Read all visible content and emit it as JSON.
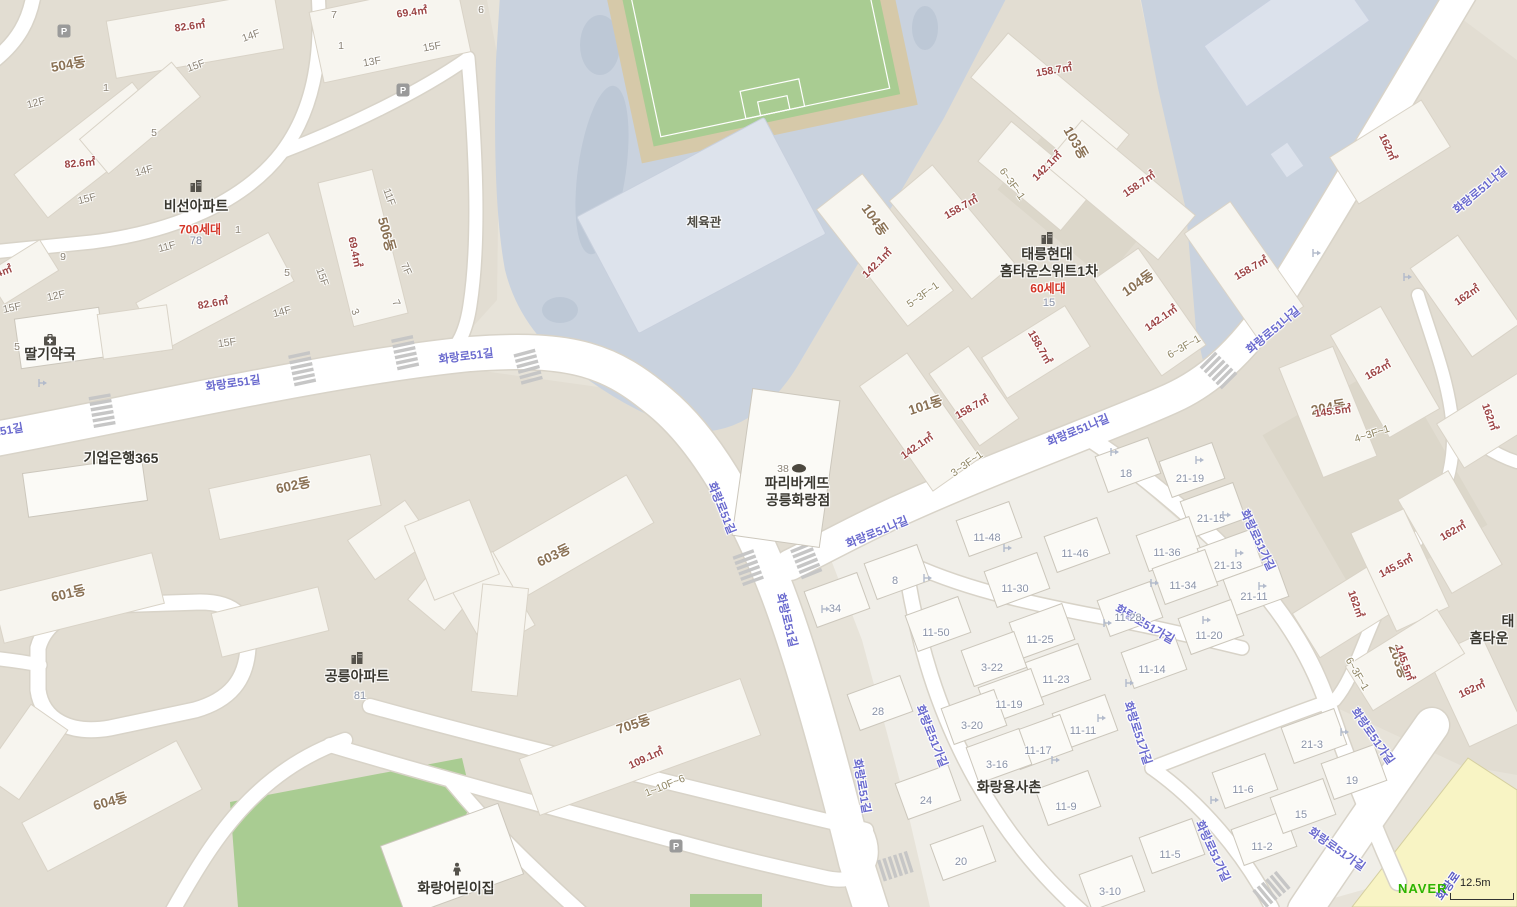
{
  "map": {
    "attribution": "NAVER",
    "scale": "12.5m",
    "colors": {
      "road_label": "#6a6ace",
      "dong_label": "#8a7154",
      "area_label": "#9c4444",
      "lot_label": "#8a93a8",
      "households_label": "#d43527",
      "poi_label": "#39372f",
      "school_ground": "#c9d2de",
      "field_green": "#a9cc92",
      "major_road_yellow": "#f8f4c4",
      "brand_green": "#2db400"
    },
    "labels": [
      {
        "t": "화랑로51길",
        "x": -4,
        "y": 432,
        "r": -10,
        "c": "road"
      },
      {
        "t": "화랑로51길",
        "x": 233,
        "y": 383,
        "r": -8,
        "c": "road"
      },
      {
        "t": "화랑로51길",
        "x": 466,
        "y": 356,
        "r": -7,
        "c": "road"
      },
      {
        "t": "화랑로51길",
        "x": 722,
        "y": 508,
        "r": 68,
        "c": "road"
      },
      {
        "t": "화랑로51길",
        "x": 787,
        "y": 620,
        "r": 76,
        "c": "road"
      },
      {
        "t": "화랑로51길",
        "x": 862,
        "y": 786,
        "r": 80,
        "c": "road"
      },
      {
        "t": "화랑로51나길",
        "x": 877,
        "y": 532,
        "r": -22,
        "c": "road"
      },
      {
        "t": "화랑로51나길",
        "x": 1078,
        "y": 430,
        "r": -22,
        "c": "road"
      },
      {
        "t": "화랑로51나길",
        "x": 1273,
        "y": 330,
        "r": -40,
        "c": "road"
      },
      {
        "t": "화랑로51나길",
        "x": 1480,
        "y": 190,
        "r": -40,
        "c": "road"
      },
      {
        "t": "화랑로51가길",
        "x": 1258,
        "y": 540,
        "r": 65,
        "c": "road"
      },
      {
        "t": "화랑로51가길",
        "x": 1145,
        "y": 624,
        "r": 30,
        "c": "road"
      },
      {
        "t": "화랑로51가길",
        "x": 932,
        "y": 736,
        "r": 68,
        "c": "road"
      },
      {
        "t": "화랑로51가길",
        "x": 1138,
        "y": 733,
        "r": 72,
        "c": "road"
      },
      {
        "t": "화랑로51가길",
        "x": 1213,
        "y": 851,
        "r": 65,
        "c": "road"
      },
      {
        "t": "화랑로51가길",
        "x": 1373,
        "y": 736,
        "r": 55,
        "c": "road"
      },
      {
        "t": "화랑로51가길",
        "x": 1337,
        "y": 849,
        "r": 35,
        "c": "road"
      },
      {
        "t": "화랑로",
        "x": 1448,
        "y": 886,
        "r": -55,
        "c": "roadY"
      },
      {
        "t": "504동",
        "x": 68,
        "y": 63,
        "r": -10,
        "c": "dong"
      },
      {
        "t": "506동",
        "x": 388,
        "y": 234,
        "r": 75,
        "c": "dong"
      },
      {
        "t": "601동",
        "x": 68,
        "y": 592,
        "r": -13,
        "c": "dong"
      },
      {
        "t": "602동",
        "x": 293,
        "y": 484,
        "r": -12,
        "c": "dong"
      },
      {
        "t": "603동",
        "x": 553,
        "y": 554,
        "r": -25,
        "c": "dong"
      },
      {
        "t": "604동",
        "x": 110,
        "y": 800,
        "r": -15,
        "c": "dong"
      },
      {
        "t": "705동",
        "x": 633,
        "y": 723,
        "r": -18,
        "c": "dong"
      },
      {
        "t": "101동",
        "x": 925,
        "y": 404,
        "r": -18,
        "c": "dong"
      },
      {
        "t": "103동",
        "x": 1077,
        "y": 142,
        "r": 60,
        "c": "dong"
      },
      {
        "t": "104동",
        "x": 876,
        "y": 219,
        "r": 55,
        "c": "dong"
      },
      {
        "t": "104동",
        "x": 1137,
        "y": 282,
        "r": -35,
        "c": "dong"
      },
      {
        "t": "204동",
        "x": 1328,
        "y": 406,
        "r": -10,
        "c": "dong"
      },
      {
        "t": "203동",
        "x": 1400,
        "y": 661,
        "r": 70,
        "c": "dong"
      },
      {
        "t": "82.6㎡",
        "x": 190,
        "y": 26,
        "r": -8,
        "c": "area"
      },
      {
        "t": "82.6㎡",
        "x": 80,
        "y": 163,
        "r": -5,
        "c": "area"
      },
      {
        "t": "82.6㎡",
        "x": 213,
        "y": 303,
        "r": -10,
        "c": "area"
      },
      {
        "t": "69.4㎡",
        "x": 412,
        "y": 12,
        "r": -8,
        "c": "area"
      },
      {
        "t": "69.4㎡",
        "x": 355,
        "y": 252,
        "r": 78,
        "c": "area"
      },
      {
        "t": "142.1㎡",
        "x": 1047,
        "y": 166,
        "r": -45,
        "c": "area"
      },
      {
        "t": "142.1㎡",
        "x": 877,
        "y": 263,
        "r": -45,
        "c": "area"
      },
      {
        "t": "142.1㎡",
        "x": 1161,
        "y": 318,
        "r": -35,
        "c": "area"
      },
      {
        "t": "142.1㎡",
        "x": 917,
        "y": 446,
        "r": -35,
        "c": "area"
      },
      {
        "t": "158.7㎡",
        "x": 1054,
        "y": 70,
        "r": -10,
        "c": "area"
      },
      {
        "t": "158.7㎡",
        "x": 961,
        "y": 207,
        "r": -30,
        "c": "area"
      },
      {
        "t": "158.7㎡",
        "x": 1139,
        "y": 184,
        "r": -35,
        "c": "area"
      },
      {
        "t": "158.7㎡",
        "x": 1251,
        "y": 268,
        "r": -30,
        "c": "area"
      },
      {
        "t": "158.7㎡",
        "x": 1040,
        "y": 347,
        "r": 60,
        "c": "area"
      },
      {
        "t": "158.7㎡",
        "x": 972,
        "y": 407,
        "r": -30,
        "c": "area"
      },
      {
        "t": "109.1㎡",
        "x": 646,
        "y": 758,
        "r": -25,
        "c": "area"
      },
      {
        "t": "162㎡",
        "x": 1388,
        "y": 147,
        "r": 65,
        "c": "area"
      },
      {
        "t": "162㎡",
        "x": 1467,
        "y": 295,
        "r": -35,
        "c": "area"
      },
      {
        "t": "162㎡",
        "x": 1378,
        "y": 370,
        "r": -30,
        "c": "area"
      },
      {
        "t": "162㎡",
        "x": 1490,
        "y": 417,
        "r": 70,
        "c": "area"
      },
      {
        "t": "162㎡",
        "x": 1453,
        "y": 531,
        "r": -30,
        "c": "area"
      },
      {
        "t": "162㎡",
        "x": 1356,
        "y": 604,
        "r": 70,
        "c": "area"
      },
      {
        "t": "162㎡",
        "x": 1472,
        "y": 689,
        "r": -25,
        "c": "area"
      },
      {
        "t": "145.5㎡",
        "x": 1333,
        "y": 411,
        "r": -8,
        "c": "area"
      },
      {
        "t": "145.5㎡",
        "x": 1396,
        "y": 566,
        "r": -28,
        "c": "area"
      },
      {
        "t": "145.5㎡",
        "x": 1405,
        "y": 663,
        "r": 70,
        "c": "area"
      },
      {
        "t": "4㎡",
        "x": 4,
        "y": 271,
        "r": -20,
        "c": "area"
      },
      {
        "t": "6~3F~1",
        "x": 1012,
        "y": 184,
        "r": 55,
        "c": "range"
      },
      {
        "t": "5~3F~1",
        "x": 923,
        "y": 295,
        "r": -35,
        "c": "range"
      },
      {
        "t": "6~3F~1",
        "x": 1184,
        "y": 347,
        "r": -30,
        "c": "range"
      },
      {
        "t": "3~3F~1",
        "x": 967,
        "y": 464,
        "r": -35,
        "c": "range"
      },
      {
        "t": "4~3F~1",
        "x": 1372,
        "y": 434,
        "r": -18,
        "c": "range"
      },
      {
        "t": "6~3F~1",
        "x": 1357,
        "y": 674,
        "r": 60,
        "c": "range"
      },
      {
        "t": "1~10F~6",
        "x": 665,
        "y": 786,
        "r": -22,
        "c": "range"
      },
      {
        "t": "15F",
        "x": 196,
        "y": 66,
        "r": -20,
        "c": "floor"
      },
      {
        "t": "14F",
        "x": 251,
        "y": 36,
        "r": -20,
        "c": "floor"
      },
      {
        "t": "12F",
        "x": 36,
        "y": 103,
        "r": -15,
        "c": "floor"
      },
      {
        "t": "15F",
        "x": 87,
        "y": 199,
        "r": -15,
        "c": "floor"
      },
      {
        "t": "14F",
        "x": 144,
        "y": 171,
        "r": -15,
        "c": "floor"
      },
      {
        "t": "1",
        "x": 106,
        "y": 88,
        "r": 0,
        "c": "floor"
      },
      {
        "t": "5",
        "x": 154,
        "y": 133,
        "r": 0,
        "c": "floor"
      },
      {
        "t": "7",
        "x": 334,
        "y": 15,
        "r": 0,
        "c": "floor"
      },
      {
        "t": "1",
        "x": 341,
        "y": 46,
        "r": 0,
        "c": "floor"
      },
      {
        "t": "13F",
        "x": 372,
        "y": 62,
        "r": -10,
        "c": "floor"
      },
      {
        "t": "15F",
        "x": 432,
        "y": 47,
        "r": -10,
        "c": "floor"
      },
      {
        "t": "11F",
        "x": 389,
        "y": 197,
        "r": 70,
        "c": "floor"
      },
      {
        "t": "15F",
        "x": 322,
        "y": 277,
        "r": 70,
        "c": "floor"
      },
      {
        "t": "7F",
        "x": 406,
        "y": 269,
        "r": 65,
        "c": "floor"
      },
      {
        "t": "1",
        "x": 238,
        "y": 230,
        "r": 0,
        "c": "floor"
      },
      {
        "t": "11F",
        "x": 167,
        "y": 247,
        "r": -15,
        "c": "floor"
      },
      {
        "t": "5",
        "x": 287,
        "y": 273,
        "r": 0,
        "c": "floor"
      },
      {
        "t": "14F",
        "x": 282,
        "y": 312,
        "r": -15,
        "c": "floor"
      },
      {
        "t": "9",
        "x": 63,
        "y": 257,
        "r": 0,
        "c": "floor"
      },
      {
        "t": "12F",
        "x": 56,
        "y": 296,
        "r": -12,
        "c": "floor"
      },
      {
        "t": "15F",
        "x": 12,
        "y": 308,
        "r": -12,
        "c": "floor"
      },
      {
        "t": "15F",
        "x": 227,
        "y": 343,
        "r": -8,
        "c": "floor"
      },
      {
        "t": "5",
        "x": 17,
        "y": 347,
        "r": 0,
        "c": "floor"
      },
      {
        "t": "6",
        "x": 481,
        "y": 10,
        "r": 0,
        "c": "floor"
      },
      {
        "t": "3",
        "x": 355,
        "y": 312,
        "r": 65,
        "c": "floor"
      },
      {
        "t": "7",
        "x": 396,
        "y": 303,
        "r": 65,
        "c": "floor"
      },
      {
        "t": "38",
        "x": 783,
        "y": 469,
        "r": 0,
        "c": "floor"
      },
      {
        "t": "78",
        "x": 196,
        "y": 241,
        "r": 0,
        "c": "lotp"
      },
      {
        "t": "81",
        "x": 360,
        "y": 696,
        "r": 0,
        "c": "lotp"
      },
      {
        "t": "15",
        "x": 1049,
        "y": 303,
        "r": 0,
        "c": "lotp"
      },
      {
        "t": "28",
        "x": 878,
        "y": 712,
        "r": 0,
        "c": "lot"
      },
      {
        "t": "24",
        "x": 926,
        "y": 801,
        "r": 0,
        "c": "lot"
      },
      {
        "t": "20",
        "x": 961,
        "y": 862,
        "r": 0,
        "c": "lot"
      },
      {
        "t": "34",
        "x": 835,
        "y": 609,
        "r": 0,
        "c": "lot"
      },
      {
        "t": "8",
        "x": 895,
        "y": 581,
        "r": 0,
        "c": "lot"
      },
      {
        "t": "18",
        "x": 1126,
        "y": 474,
        "r": 0,
        "c": "lot"
      },
      {
        "t": "21-19",
        "x": 1190,
        "y": 479,
        "r": 0,
        "c": "lot"
      },
      {
        "t": "21-15",
        "x": 1211,
        "y": 519,
        "r": 0,
        "c": "lot"
      },
      {
        "t": "11-48",
        "x": 987,
        "y": 538,
        "r": 0,
        "c": "lot"
      },
      {
        "t": "11-46",
        "x": 1075,
        "y": 554,
        "r": 0,
        "c": "lot"
      },
      {
        "t": "11-36",
        "x": 1167,
        "y": 553,
        "r": 0,
        "c": "lot"
      },
      {
        "t": "21-13",
        "x": 1228,
        "y": 566,
        "r": 0,
        "c": "lot"
      },
      {
        "t": "11-30",
        "x": 1015,
        "y": 589,
        "r": 0,
        "c": "lot"
      },
      {
        "t": "11-34",
        "x": 1183,
        "y": 586,
        "r": 0,
        "c": "lot"
      },
      {
        "t": "21-11",
        "x": 1254,
        "y": 597,
        "r": 0,
        "c": "lot"
      },
      {
        "t": "11-28",
        "x": 1128,
        "y": 618,
        "r": 0,
        "c": "lot"
      },
      {
        "t": "11-50",
        "x": 936,
        "y": 633,
        "r": 0,
        "c": "lot"
      },
      {
        "t": "11-25",
        "x": 1040,
        "y": 640,
        "r": 0,
        "c": "lot"
      },
      {
        "t": "11-20",
        "x": 1209,
        "y": 636,
        "r": 0,
        "c": "lot"
      },
      {
        "t": "3-22",
        "x": 992,
        "y": 668,
        "r": 0,
        "c": "lot"
      },
      {
        "t": "11-23",
        "x": 1056,
        "y": 680,
        "r": 0,
        "c": "lot"
      },
      {
        "t": "11-14",
        "x": 1152,
        "y": 670,
        "r": 0,
        "c": "lot"
      },
      {
        "t": "11-19",
        "x": 1009,
        "y": 705,
        "r": 0,
        "c": "lot"
      },
      {
        "t": "3-20",
        "x": 972,
        "y": 726,
        "r": 0,
        "c": "lot"
      },
      {
        "t": "11-11",
        "x": 1083,
        "y": 731,
        "r": 0,
        "c": "lot"
      },
      {
        "t": "11-17",
        "x": 1038,
        "y": 751,
        "r": 0,
        "c": "lot"
      },
      {
        "t": "3-16",
        "x": 997,
        "y": 765,
        "r": 0,
        "c": "lot"
      },
      {
        "t": "11-9",
        "x": 1066,
        "y": 807,
        "r": 0,
        "c": "lot"
      },
      {
        "t": "3-10",
        "x": 1110,
        "y": 892,
        "r": 0,
        "c": "lot"
      },
      {
        "t": "11-5",
        "x": 1170,
        "y": 855,
        "r": 0,
        "c": "lot"
      },
      {
        "t": "11-6",
        "x": 1243,
        "y": 790,
        "r": 0,
        "c": "lot"
      },
      {
        "t": "11-2",
        "x": 1262,
        "y": 847,
        "r": 0,
        "c": "lot"
      },
      {
        "t": "15",
        "x": 1301,
        "y": 815,
        "r": 0,
        "c": "lot"
      },
      {
        "t": "19",
        "x": 1352,
        "y": 781,
        "r": 0,
        "c": "lot"
      },
      {
        "t": "21-3",
        "x": 1312,
        "y": 745,
        "r": 0,
        "c": "lot"
      },
      {
        "t": "비선아파트",
        "x": 196,
        "y": 206,
        "r": 0,
        "c": "poi",
        "n": "poi-biseon-apartment"
      },
      {
        "t": "700세대",
        "x": 200,
        "y": 229,
        "r": 0,
        "c": "hh"
      },
      {
        "t": "태릉현대",
        "x": 1047,
        "y": 254,
        "r": 0,
        "c": "poi",
        "n": "poi-taereung-hyundai-line1"
      },
      {
        "t": "홈타운스위트1차",
        "x": 1049,
        "y": 271,
        "r": 0,
        "c": "poi",
        "n": "poi-taereung-hyundai-line2"
      },
      {
        "t": "60세대",
        "x": 1048,
        "y": 288,
        "r": 0,
        "c": "hh"
      },
      {
        "t": "공릉아파트",
        "x": 357,
        "y": 676,
        "r": 0,
        "c": "poi",
        "n": "poi-gongneung-apartment"
      },
      {
        "t": "딸기약국",
        "x": 50,
        "y": 354,
        "r": 0,
        "c": "poi",
        "n": "poi-ddalgi-pharmacy"
      },
      {
        "t": "기업은행365",
        "x": 121,
        "y": 458,
        "r": 0,
        "c": "poi",
        "n": "poi-ibk-bank-365"
      },
      {
        "t": "파리바게뜨",
        "x": 797,
        "y": 483,
        "r": 0,
        "c": "poi",
        "n": "poi-paris-baguette-line1"
      },
      {
        "t": "공릉화랑점",
        "x": 798,
        "y": 500,
        "r": 0,
        "c": "poi",
        "n": "poi-paris-baguette-line2"
      },
      {
        "t": "체육관",
        "x": 704,
        "y": 221,
        "r": 0,
        "c": "poi2",
        "n": "poi-gymnasium"
      },
      {
        "t": "화랑용사촌",
        "x": 1009,
        "y": 787,
        "r": 0,
        "c": "poi",
        "n": "poi-hwarang-yongsachon"
      },
      {
        "t": "화랑어린이집",
        "x": 456,
        "y": 888,
        "r": 0,
        "c": "poi",
        "n": "poi-hwarang-daycare"
      },
      {
        "t": "태",
        "x": 1508,
        "y": 621,
        "r": 0,
        "c": "poi",
        "n": "poi-clipped-line1"
      },
      {
        "t": "홈타운",
        "x": 1489,
        "y": 638,
        "r": 0,
        "c": "poi",
        "n": "poi-clipped-line2"
      }
    ],
    "icons": [
      {
        "t": "apartment",
        "x": 196,
        "y": 186
      },
      {
        "t": "apartment",
        "x": 1047,
        "y": 238
      },
      {
        "t": "apartment",
        "x": 357,
        "y": 658
      },
      {
        "t": "pharmacy",
        "x": 50,
        "y": 340
      },
      {
        "t": "bakery",
        "x": 799,
        "y": 468
      },
      {
        "t": "child",
        "x": 457,
        "y": 869
      },
      {
        "t": "parking",
        "x": 64,
        "y": 31
      },
      {
        "t": "parking",
        "x": 403,
        "y": 90
      },
      {
        "t": "parking",
        "x": 676,
        "y": 846
      },
      {
        "t": "entrance",
        "x": 43,
        "y": 383
      },
      {
        "t": "entrance",
        "x": 826,
        "y": 609
      },
      {
        "t": "entrance",
        "x": 928,
        "y": 578
      },
      {
        "t": "entrance",
        "x": 1008,
        "y": 548
      },
      {
        "t": "entrance",
        "x": 1115,
        "y": 452
      },
      {
        "t": "entrance",
        "x": 1200,
        "y": 460
      },
      {
        "t": "entrance",
        "x": 1227,
        "y": 515
      },
      {
        "t": "entrance",
        "x": 1240,
        "y": 553
      },
      {
        "t": "entrance",
        "x": 1155,
        "y": 583
      },
      {
        "t": "entrance",
        "x": 1263,
        "y": 586
      },
      {
        "t": "entrance",
        "x": 1108,
        "y": 623
      },
      {
        "t": "entrance",
        "x": 1207,
        "y": 620
      },
      {
        "t": "entrance",
        "x": 1130,
        "y": 683
      },
      {
        "t": "entrance",
        "x": 1317,
        "y": 253
      },
      {
        "t": "entrance",
        "x": 1408,
        "y": 277
      },
      {
        "t": "entrance",
        "x": 1345,
        "y": 732
      },
      {
        "t": "entrance",
        "x": 1215,
        "y": 800
      },
      {
        "t": "entrance",
        "x": 1102,
        "y": 718
      },
      {
        "t": "entrance",
        "x": 1056,
        "y": 760
      }
    ]
  }
}
